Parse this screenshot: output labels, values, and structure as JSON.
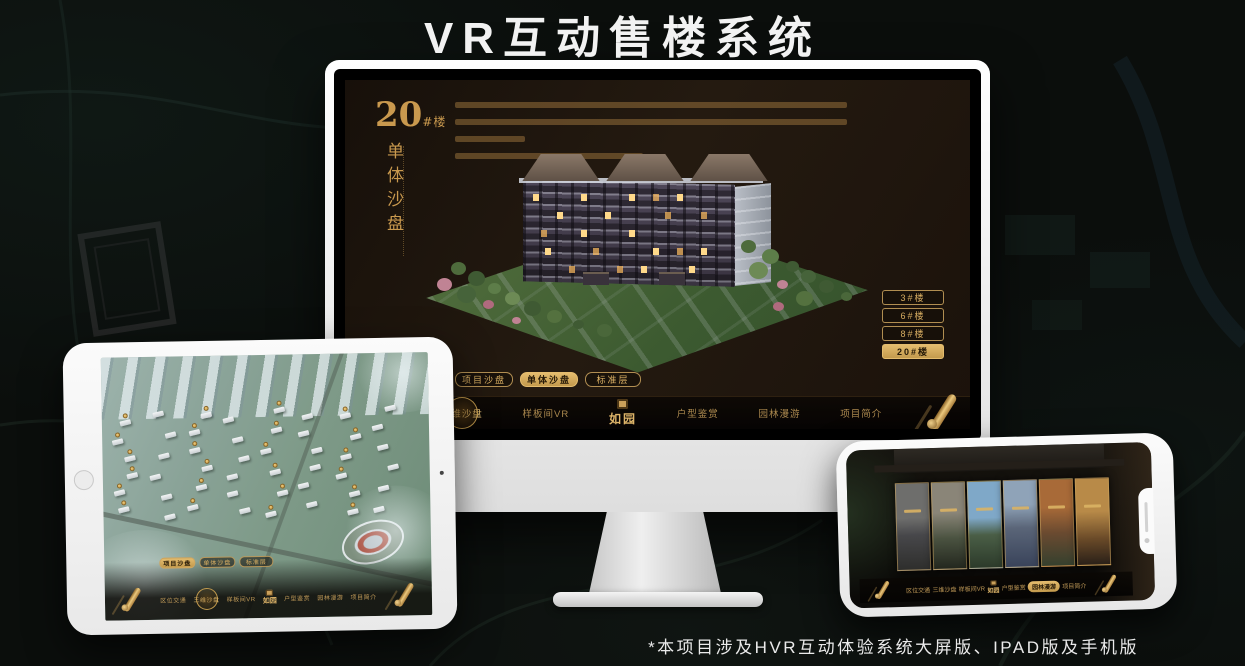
{
  "page": {
    "title": "VR互动售楼系统",
    "footnote": "*本项目涉及HVR互动体验系统大屏版、IPAD版及手机版"
  },
  "brand": {
    "logo_text": "如园"
  },
  "colors": {
    "gold": "#c9994e",
    "gold_bright": "#e4bc6e",
    "screen_bg": "#1b120b",
    "page_bg": "#0b0e0c",
    "active_text": "#241806"
  },
  "sales_ui": {
    "building_heading": {
      "number": "20",
      "suffix": "#楼",
      "subtitle_vertical": "单体沙盘"
    },
    "floor_buttons": [
      {
        "label": "3#楼",
        "active": false
      },
      {
        "label": "6#楼",
        "active": false
      },
      {
        "label": "8#楼",
        "active": false
      },
      {
        "label": "20#楼",
        "active": true
      }
    ],
    "mode_tabs": [
      "项目沙盘",
      "单体沙盘",
      "标准层"
    ],
    "nav_items": [
      "区位交通",
      "三维沙盘",
      "样板间VR",
      "户型鉴赏",
      "园林漫游",
      "项目简介"
    ],
    "monitor_state": {
      "active_tab": "单体沙盘",
      "active_nav": "三维沙盘",
      "active_floor": "20#楼"
    },
    "ipad_state": {
      "active_tab": "项目沙盘",
      "active_nav": "三维沙盘"
    },
    "phone_state": {
      "active_nav": "园林漫游"
    }
  }
}
